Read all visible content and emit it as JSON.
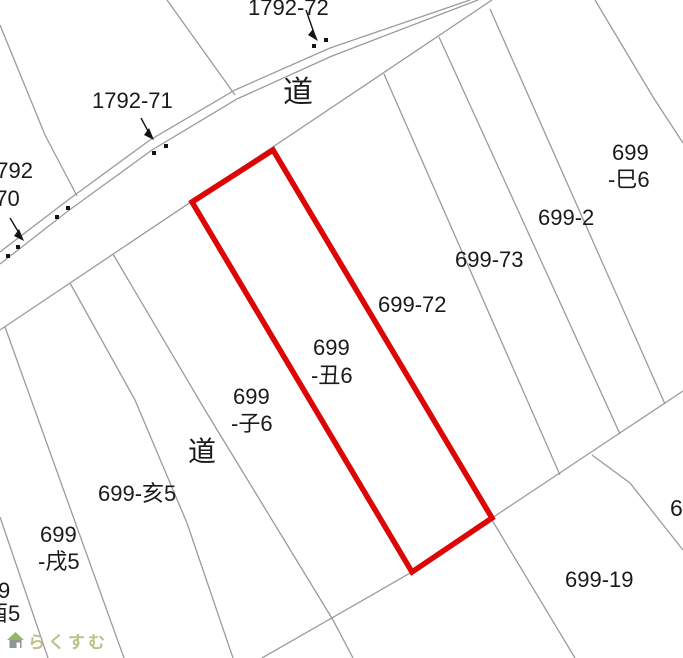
{
  "canvas": {
    "width": 683,
    "height": 658,
    "background": "#ffffff"
  },
  "colors": {
    "boundary_line": "#9b9b9b",
    "road_line": "#9b9b9b",
    "label_text": "#1a1a1a",
    "highlight_red": "#dd0606",
    "marker_black": "#141414",
    "logo_text": "#bfbf88",
    "logo_roof": "#9ab36b",
    "logo_body": "#8f9696"
  },
  "highlight_parcel": {
    "label": "699-丑6",
    "points": [
      [
        192,
        202
      ],
      [
        273,
        150
      ],
      [
        492,
        518
      ],
      [
        412,
        572
      ]
    ],
    "stroke_width": 5.5
  },
  "road_edge_lines": [
    {
      "name": "road-north-edge-outer",
      "points": [
        [
          0,
          252
        ],
        [
          68,
          200
        ],
        [
          150,
          140
        ],
        [
          235,
          90
        ],
        [
          330,
          48
        ],
        [
          470,
          0
        ]
      ]
    },
    {
      "name": "road-north-edge-inner",
      "points": [
        [
          0,
          264
        ],
        [
          68,
          211
        ],
        [
          152,
          150
        ],
        [
          237,
          99
        ],
        [
          332,
          56
        ],
        [
          478,
          0
        ]
      ]
    },
    {
      "name": "road-south-edge",
      "points": [
        [
          0,
          330
        ],
        [
          492,
          0
        ]
      ]
    }
  ],
  "boundary_lines": [
    {
      "name": "b-1792-70-71",
      "points": [
        [
          0,
          25
        ],
        [
          45,
          135
        ],
        [
          77,
          196
        ]
      ]
    },
    {
      "name": "b-1792-71-72",
      "points": [
        [
          167,
          0
        ],
        [
          235,
          95
        ]
      ]
    },
    {
      "name": "b-west-of-road-strip",
      "points": [
        [
          70,
          283
        ],
        [
          135,
          400
        ],
        [
          187,
          523
        ],
        [
          233,
          658
        ]
      ]
    },
    {
      "name": "b-roadstrip-ko6",
      "points": [
        [
          113,
          254
        ],
        [
          205,
          410
        ],
        [
          333,
          620
        ],
        [
          353,
          658
        ]
      ]
    },
    {
      "name": "b-long-south",
      "points": [
        [
          262,
          658
        ],
        [
          412,
          572
        ],
        [
          492,
          518
        ],
        [
          683,
          391
        ]
      ]
    },
    {
      "name": "b-72-73",
      "points": [
        [
          384,
          74
        ],
        [
          560,
          475
        ]
      ]
    },
    {
      "name": "b-73-2",
      "points": [
        [
          439,
          37
        ],
        [
          620,
          434
        ]
      ]
    },
    {
      "name": "b-2-mi6",
      "points": [
        [
          490,
          9
        ],
        [
          665,
          404
        ]
      ]
    },
    {
      "name": "b-east-of-mi6",
      "points": [
        [
          595,
          0
        ],
        [
          653,
          97
        ],
        [
          683,
          143
        ]
      ]
    },
    {
      "name": "b-19-west",
      "points": [
        [
          492,
          520
        ],
        [
          575,
          658
        ]
      ]
    },
    {
      "name": "b-19-east",
      "points": [
        [
          592,
          455
        ],
        [
          630,
          483
        ],
        [
          683,
          550
        ]
      ]
    },
    {
      "name": "b-inu5-i5",
      "points": [
        [
          5,
          327
        ],
        [
          124,
          658
        ]
      ]
    },
    {
      "name": "b-tori5-inu5",
      "points": [
        [
          0,
          517
        ],
        [
          48,
          658
        ]
      ]
    }
  ],
  "labels": [
    {
      "id": "parcel-1792-72",
      "text": "1792-72",
      "x": 248,
      "y": -5,
      "fs": 22
    },
    {
      "id": "road-label-top",
      "text": "道",
      "x": 283,
      "y": 76,
      "fs": 30
    },
    {
      "id": "parcel-1792-71",
      "text": "1792-71",
      "x": 92,
      "y": 88,
      "fs": 22
    },
    {
      "id": "parcel-1792-70-line1",
      "text": "1792",
      "x": -16,
      "y": 158,
      "fs": 22
    },
    {
      "id": "parcel-1792-70-line2",
      "text": "-70",
      "x": -12,
      "y": 186,
      "fs": 22
    },
    {
      "id": "parcel-699-mi6-line1",
      "text": "699",
      "x": 612,
      "y": 140,
      "fs": 22
    },
    {
      "id": "parcel-699-mi6-line2",
      "text": "-巳6",
      "x": 608,
      "y": 167,
      "fs": 22
    },
    {
      "id": "parcel-699-2",
      "text": "699-2",
      "x": 538,
      "y": 205,
      "fs": 22
    },
    {
      "id": "parcel-699-73",
      "text": "699-73",
      "x": 455,
      "y": 247,
      "fs": 22
    },
    {
      "id": "parcel-699-72",
      "text": "699-72",
      "x": 378,
      "y": 292,
      "fs": 22
    },
    {
      "id": "parcel-699-ushi6-line1",
      "text": "699",
      "x": 313,
      "y": 335,
      "fs": 22
    },
    {
      "id": "parcel-699-ushi6-line2",
      "text": "-丑6",
      "x": 311,
      "y": 363,
      "fs": 22
    },
    {
      "id": "parcel-699-ne6-line1",
      "text": "699",
      "x": 233,
      "y": 384,
      "fs": 22
    },
    {
      "id": "parcel-699-ne6-line2",
      "text": "-子6",
      "x": 231,
      "y": 411,
      "fs": 22
    },
    {
      "id": "road-label-bottom",
      "text": "道",
      "x": 188,
      "y": 436,
      "fs": 28
    },
    {
      "id": "parcel-699-i5",
      "text": "699-亥5",
      "x": 98,
      "y": 481,
      "fs": 22
    },
    {
      "id": "parcel-699-inu5-line1",
      "text": "699",
      "x": 40,
      "y": 522,
      "fs": 22
    },
    {
      "id": "parcel-699-inu5-line2",
      "text": "-戌5",
      "x": 38,
      "y": 549,
      "fs": 22
    },
    {
      "id": "parcel-cut-9",
      "text": "9",
      "x": -2,
      "y": 578,
      "fs": 22
    },
    {
      "id": "parcel-cut-tori5",
      "text": "酉5",
      "x": -14,
      "y": 601,
      "fs": 22
    },
    {
      "id": "parcel-699-19",
      "text": "699-19",
      "x": 565,
      "y": 567,
      "fs": 22
    },
    {
      "id": "parcel-cut-6",
      "text": "6",
      "x": 670,
      "y": 495,
      "fs": 23
    }
  ],
  "leader_arrows": [
    {
      "for": "1792-72",
      "line": [
        [
          306,
          10
        ],
        [
          314,
          33
        ]
      ],
      "head": [
        [
          318,
          41
        ],
        [
          308,
          35
        ],
        [
          313,
          29
        ]
      ]
    },
    {
      "for": "1792-71",
      "line": [
        [
          141,
          118
        ],
        [
          149,
          133
        ]
      ],
      "head": [
        [
          154,
          140
        ],
        [
          144,
          135
        ],
        [
          149,
          128
        ]
      ]
    },
    {
      "for": "1792-70",
      "line": [
        [
          10,
          218
        ],
        [
          19,
          233
        ]
      ],
      "head": [
        [
          24,
          241
        ],
        [
          14,
          236
        ],
        [
          19,
          229
        ]
      ]
    }
  ],
  "survey_dots": [
    [
      314,
      46
    ],
    [
      326,
      40
    ],
    [
      154,
      153
    ],
    [
      166,
      146
    ],
    [
      57,
      217
    ],
    [
      68,
      208
    ],
    [
      18,
      247
    ],
    [
      8,
      256
    ]
  ],
  "logo": {
    "icon": "house-icon",
    "text": "らくすむ"
  }
}
